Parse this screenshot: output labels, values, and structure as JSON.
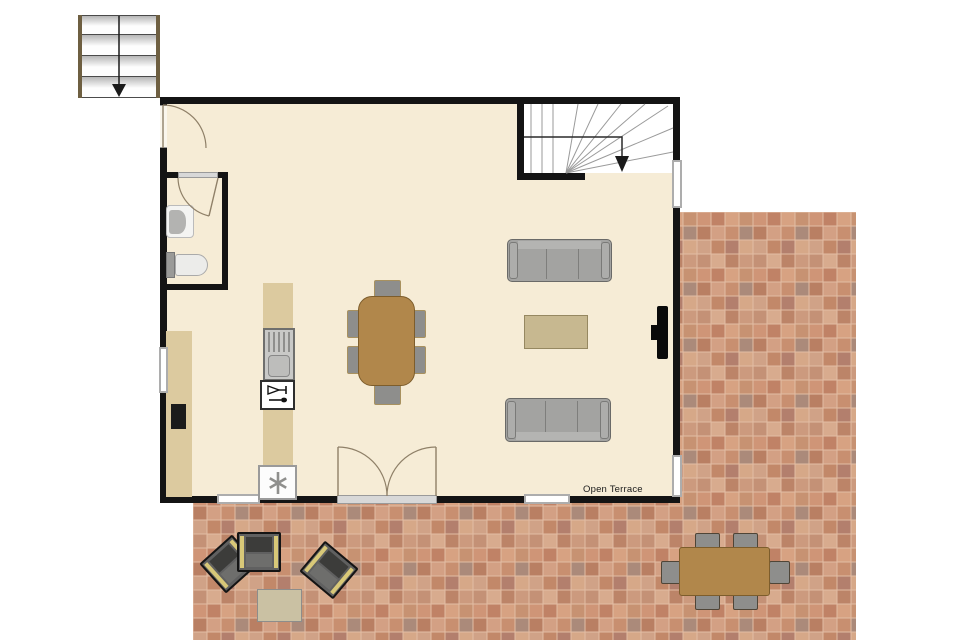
{
  "plan": {
    "terrace_label": "Open Terrace"
  },
  "colors": {
    "wall": "#141414",
    "floor": "#f6ecd6",
    "counter_wood": "#dcca9f",
    "table_wood": "#b1874b",
    "coffee_table_wood": "#c7b890",
    "sofa_gray": "#a3a3a1",
    "chair_gray": "#8e8e8c",
    "lounge_accent_yellow": "#d8c878",
    "stair_rail_brown": "#6e5f41",
    "tile_gap": "#e2bda4"
  },
  "tile_palette": [
    "#cf9577",
    "#c08266",
    "#d7a282",
    "#c79272",
    "#b97f63",
    "#d3a084",
    "#c88f70",
    "#ab8a7a",
    "#d0a287",
    "#c28869",
    "#b37f6d",
    "#d6a888",
    "#c49176",
    "#d8ab8e",
    "#bc8468",
    "#cc9a7e"
  ],
  "symbols": {
    "exterior_staircase": "stairs-down-arrow-icon",
    "interior_staircase": "winder-stairs-down-arrow-icon",
    "entrance_door": "single-swing-door-icon",
    "bathroom_door": "single-swing-door-icon",
    "terrace_door": "double-swing-door-icon",
    "toilet": "toilet-icon",
    "sink": "washbasin-icon",
    "kitchen_sink": "sink-with-drainer-icon",
    "utensil_box": "kitchen-utensil-icon",
    "cooktop_box": "asterisk-cooktop-icon",
    "oven": "built-in-appliance-icon",
    "tv": "wall-tv-icon"
  }
}
